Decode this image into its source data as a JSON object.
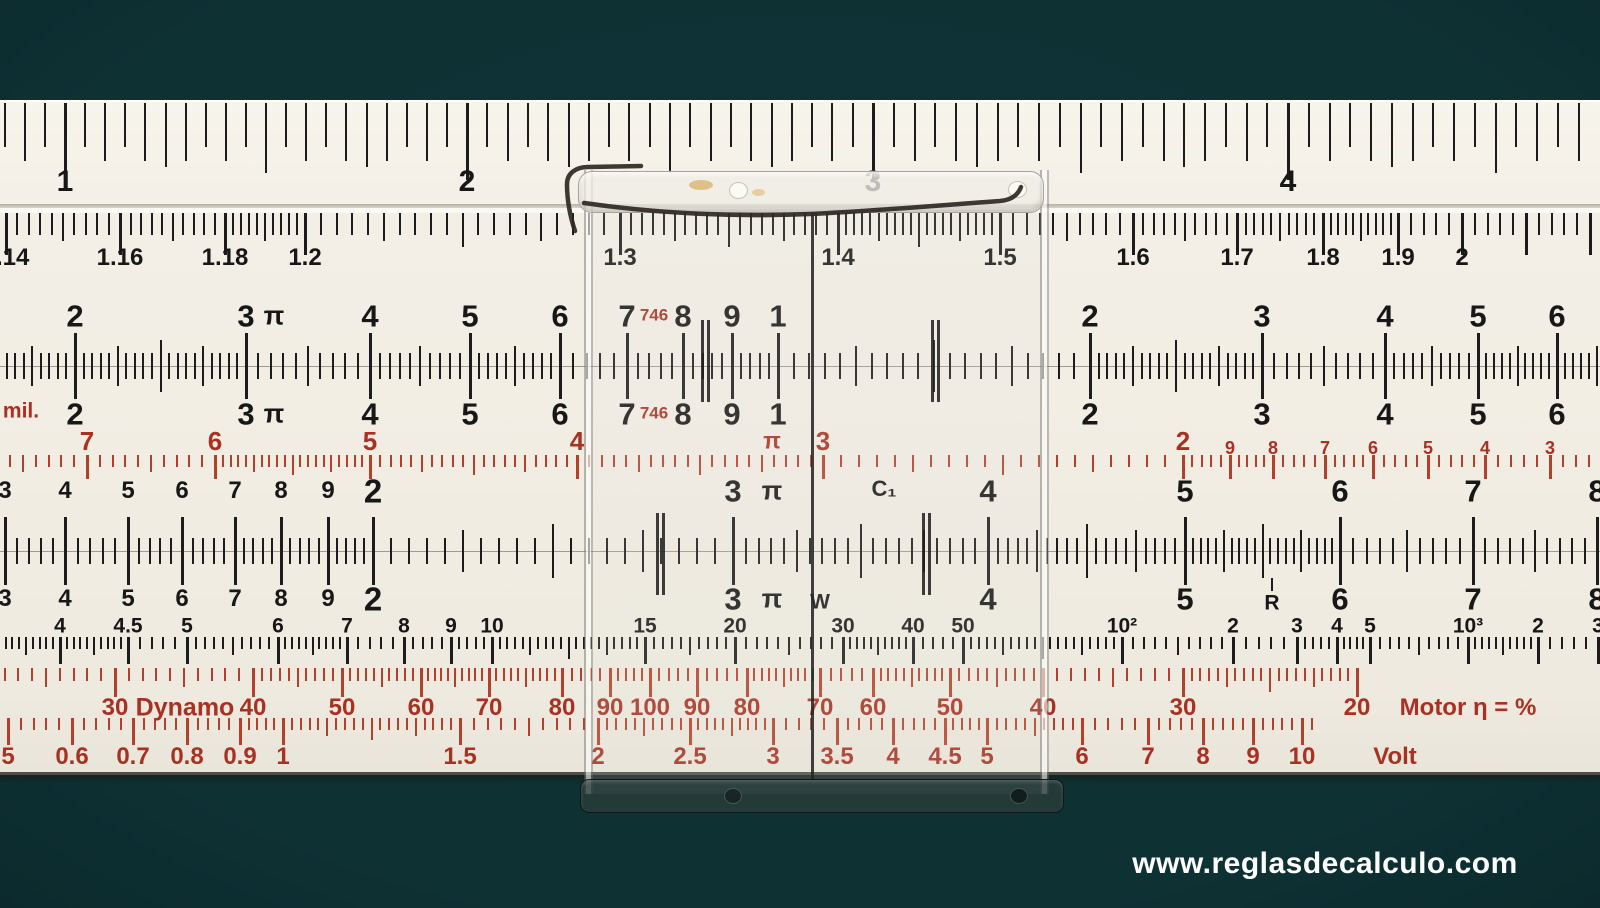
{
  "colors": {
    "background": "#0e3134",
    "rule_body": "#f2eee5",
    "tick_black": "#1c1c1c",
    "scale_red_text": "#a93122",
    "scale_red_tick": "#b5402a",
    "watermark": "#ffffff"
  },
  "watermark": {
    "text": "www.reglasdecalculo.com"
  },
  "rule": {
    "scales": {
      "top_ruler": {
        "labels": [
          {
            "t": "1",
            "x": 65
          },
          {
            "t": "2",
            "x": 467
          },
          {
            "t": "3",
            "x": 873
          },
          {
            "t": "4",
            "x": 1288
          }
        ]
      },
      "upper": {
        "labels": [
          {
            "t": "1.14",
            "x": 6
          },
          {
            "t": "1.16",
            "x": 120
          },
          {
            "t": "1.18",
            "x": 225
          },
          {
            "t": "1.2",
            "x": 305
          },
          {
            "t": "1.3",
            "x": 620
          },
          {
            "t": "1.4",
            "x": 838
          },
          {
            "t": "1.5",
            "x": 1000
          },
          {
            "t": "1.6",
            "x": 1133
          },
          {
            "t": "1.7",
            "x": 1237
          },
          {
            "t": "1.8",
            "x": 1323
          },
          {
            "t": "1.9",
            "x": 1398
          },
          {
            "t": "2",
            "x": 1462
          }
        ]
      },
      "A": {
        "labels": [
          {
            "t": "2",
            "x": 75
          },
          {
            "t": "3",
            "x": 246
          },
          {
            "t": "π",
            "x": 274,
            "g": 1,
            "sz": 27
          },
          {
            "t": "4",
            "x": 370
          },
          {
            "t": "5",
            "x": 470
          },
          {
            "t": "6",
            "x": 560
          },
          {
            "t": "7",
            "x": 627
          },
          {
            "t": "746",
            "x": 654,
            "g": 1,
            "red": 1,
            "sz": 17,
            "dy": -1
          },
          {
            "t": "8",
            "x": 683
          },
          {
            "t": "9",
            "x": 732
          },
          {
            "t": "1",
            "x": 778
          },
          {
            "t": "2",
            "x": 1090
          },
          {
            "t": "3",
            "x": 1262
          },
          {
            "t": "4",
            "x": 1385
          },
          {
            "t": "5",
            "x": 1478
          },
          {
            "t": "6",
            "x": 1557
          }
        ]
      },
      "B": {
        "labels": [
          {
            "t": "mil.",
            "x": 21,
            "g": 1,
            "red": 1,
            "sz": 21,
            "dy": -3
          },
          {
            "t": "2",
            "x": 75
          },
          {
            "t": "3",
            "x": 246
          },
          {
            "t": "π",
            "x": 274,
            "g": 1,
            "sz": 27
          },
          {
            "t": "4",
            "x": 370
          },
          {
            "t": "5",
            "x": 470
          },
          {
            "t": "6",
            "x": 560
          },
          {
            "t": "7",
            "x": 627
          },
          {
            "t": "746",
            "x": 654,
            "g": 1,
            "red": 1,
            "sz": 17,
            "dy": -1
          },
          {
            "t": "8",
            "x": 683
          },
          {
            "t": "9",
            "x": 732
          },
          {
            "t": "1",
            "x": 778
          },
          {
            "t": "2",
            "x": 1090
          },
          {
            "t": "3",
            "x": 1262
          },
          {
            "t": "4",
            "x": 1385
          },
          {
            "t": "5",
            "x": 1478
          },
          {
            "t": "6",
            "x": 1557
          }
        ]
      },
      "slide_red": {
        "labels": [
          {
            "t": "7",
            "x": 87
          },
          {
            "t": "6",
            "x": 215
          },
          {
            "t": "5",
            "x": 370
          },
          {
            "t": "4",
            "x": 577
          },
          {
            "t": "π",
            "x": 772,
            "g": 1,
            "sz": 23
          },
          {
            "t": "3",
            "x": 823
          },
          {
            "t": "2",
            "x": 1183
          },
          {
            "t": "9",
            "x": 1230,
            "sz": 18,
            "dy": 7
          },
          {
            "t": "8",
            "x": 1273,
            "sz": 18,
            "dy": 7
          },
          {
            "t": "7",
            "x": 1325,
            "sz": 18,
            "dy": 7
          },
          {
            "t": "6",
            "x": 1373,
            "sz": 18,
            "dy": 7
          },
          {
            "t": "5",
            "x": 1428,
            "sz": 18,
            "dy": 7
          },
          {
            "t": "4",
            "x": 1485,
            "sz": 18,
            "dy": 7
          },
          {
            "t": "3",
            "x": 1550,
            "sz": 18,
            "dy": 7
          }
        ]
      },
      "C": {
        "labels": [
          {
            "t": "3",
            "x": 5,
            "sz": 24
          },
          {
            "t": "4",
            "x": 65,
            "sz": 24
          },
          {
            "t": "5",
            "x": 128,
            "sz": 24
          },
          {
            "t": "6",
            "x": 182,
            "sz": 24
          },
          {
            "t": "7",
            "x": 235,
            "sz": 24
          },
          {
            "t": "8",
            "x": 281,
            "sz": 24
          },
          {
            "t": "9",
            "x": 328,
            "sz": 24
          },
          {
            "t": "2",
            "x": 373,
            "sz": 33
          },
          {
            "t": "3",
            "x": 733
          },
          {
            "t": "π",
            "x": 772,
            "g": 1,
            "sz": 27
          },
          {
            "t": "C₁",
            "x": 884,
            "g": 1,
            "sz": 22,
            "dy": -2
          },
          {
            "t": "4",
            "x": 988
          },
          {
            "t": "5",
            "x": 1185
          },
          {
            "t": "6",
            "x": 1340
          },
          {
            "t": "7",
            "x": 1473
          },
          {
            "t": "8",
            "x": 1597
          }
        ]
      },
      "D": {
        "labels": [
          {
            "t": "3",
            "x": 5,
            "sz": 24
          },
          {
            "t": "4",
            "x": 65,
            "sz": 24
          },
          {
            "t": "5",
            "x": 128,
            "sz": 24
          },
          {
            "t": "6",
            "x": 182,
            "sz": 24
          },
          {
            "t": "7",
            "x": 235,
            "sz": 24
          },
          {
            "t": "8",
            "x": 281,
            "sz": 24
          },
          {
            "t": "9",
            "x": 328,
            "sz": 24
          },
          {
            "t": "2",
            "x": 373,
            "sz": 33
          },
          {
            "t": "3",
            "x": 733
          },
          {
            "t": "π",
            "x": 772,
            "g": 1,
            "sz": 27
          },
          {
            "t": "W",
            "x": 820,
            "g": 1,
            "sz": 21,
            "dy": 3
          },
          {
            "t": "4",
            "x": 988
          },
          {
            "t": "5",
            "x": 1185
          },
          {
            "t": "R",
            "x": 1272,
            "g": 1,
            "sz": 21,
            "dy": 4
          },
          {
            "t": "6",
            "x": 1340
          },
          {
            "t": "7",
            "x": 1473
          },
          {
            "t": "8",
            "x": 1597
          }
        ]
      },
      "LL": {
        "labels": [
          {
            "t": "4",
            "x": 60
          },
          {
            "t": "4.5",
            "x": 128
          },
          {
            "t": "5",
            "x": 187
          },
          {
            "t": "6",
            "x": 278
          },
          {
            "t": "7",
            "x": 347
          },
          {
            "t": "8",
            "x": 404
          },
          {
            "t": "9",
            "x": 451
          },
          {
            "t": "10",
            "x": 492
          },
          {
            "t": "15",
            "x": 645
          },
          {
            "t": "20",
            "x": 735
          },
          {
            "t": "30",
            "x": 843
          },
          {
            "t": "40",
            "x": 913
          },
          {
            "t": "50",
            "x": 963
          },
          {
            "t": "10²",
            "x": 1122
          },
          {
            "t": "2",
            "x": 1233
          },
          {
            "t": "3",
            "x": 1297
          },
          {
            "t": "4",
            "x": 1337
          },
          {
            "t": "5",
            "x": 1370
          },
          {
            "t": "10³",
            "x": 1468
          },
          {
            "t": "2",
            "x": 1538
          },
          {
            "t": "3",
            "x": 1598
          }
        ]
      },
      "dynamo": {
        "labels": [
          {
            "t": "30",
            "x": 115
          },
          {
            "t": "Dynamo",
            "x": 185,
            "g": 1,
            "sz": 25
          },
          {
            "t": "40",
            "x": 253
          },
          {
            "t": "50",
            "x": 342
          },
          {
            "t": "60",
            "x": 421
          },
          {
            "t": "70",
            "x": 489
          },
          {
            "t": "80",
            "x": 562
          },
          {
            "t": "90",
            "x": 610
          },
          {
            "t": "100",
            "x": 650
          },
          {
            "t": "90",
            "x": 697
          },
          {
            "t": "80",
            "x": 747
          },
          {
            "t": "70",
            "x": 820
          },
          {
            "t": "60",
            "x": 873
          },
          {
            "t": "50",
            "x": 950
          },
          {
            "t": "40",
            "x": 1043
          },
          {
            "t": "30",
            "x": 1183
          },
          {
            "t": "20",
            "x": 1357
          },
          {
            "t": "Motor η = %",
            "x": 1468,
            "g": 1
          }
        ]
      },
      "volt": {
        "labels": [
          {
            "t": "5",
            "x": 8
          },
          {
            "t": "0.6",
            "x": 72
          },
          {
            "t": "0.7",
            "x": 133
          },
          {
            "t": "0.8",
            "x": 187
          },
          {
            "t": "0.9",
            "x": 240
          },
          {
            "t": "1",
            "x": 283
          },
          {
            "t": "1.5",
            "x": 460
          },
          {
            "t": "2",
            "x": 598
          },
          {
            "t": "2.5",
            "x": 690
          },
          {
            "t": "3",
            "x": 773
          },
          {
            "t": "3.5",
            "x": 837
          },
          {
            "t": "4",
            "x": 893
          },
          {
            "t": "4.5",
            "x": 945
          },
          {
            "t": "5",
            "x": 987
          },
          {
            "t": "6",
            "x": 1082
          },
          {
            "t": "7",
            "x": 1148
          },
          {
            "t": "8",
            "x": 1203
          },
          {
            "t": "9",
            "x": 1253
          },
          {
            "t": "10",
            "x": 1302
          },
          {
            "t": "Volt",
            "x": 1395,
            "g": 1
          }
        ]
      }
    }
  },
  "cursor": {
    "hairline_x": 812,
    "aux_marks": [
      {
        "x": 704,
        "band": "ab"
      },
      {
        "x": 934,
        "band": "ab"
      },
      {
        "x": 659,
        "band": "cd"
      },
      {
        "x": 925,
        "band": "cd"
      }
    ],
    "has_spring_clip": true
  }
}
